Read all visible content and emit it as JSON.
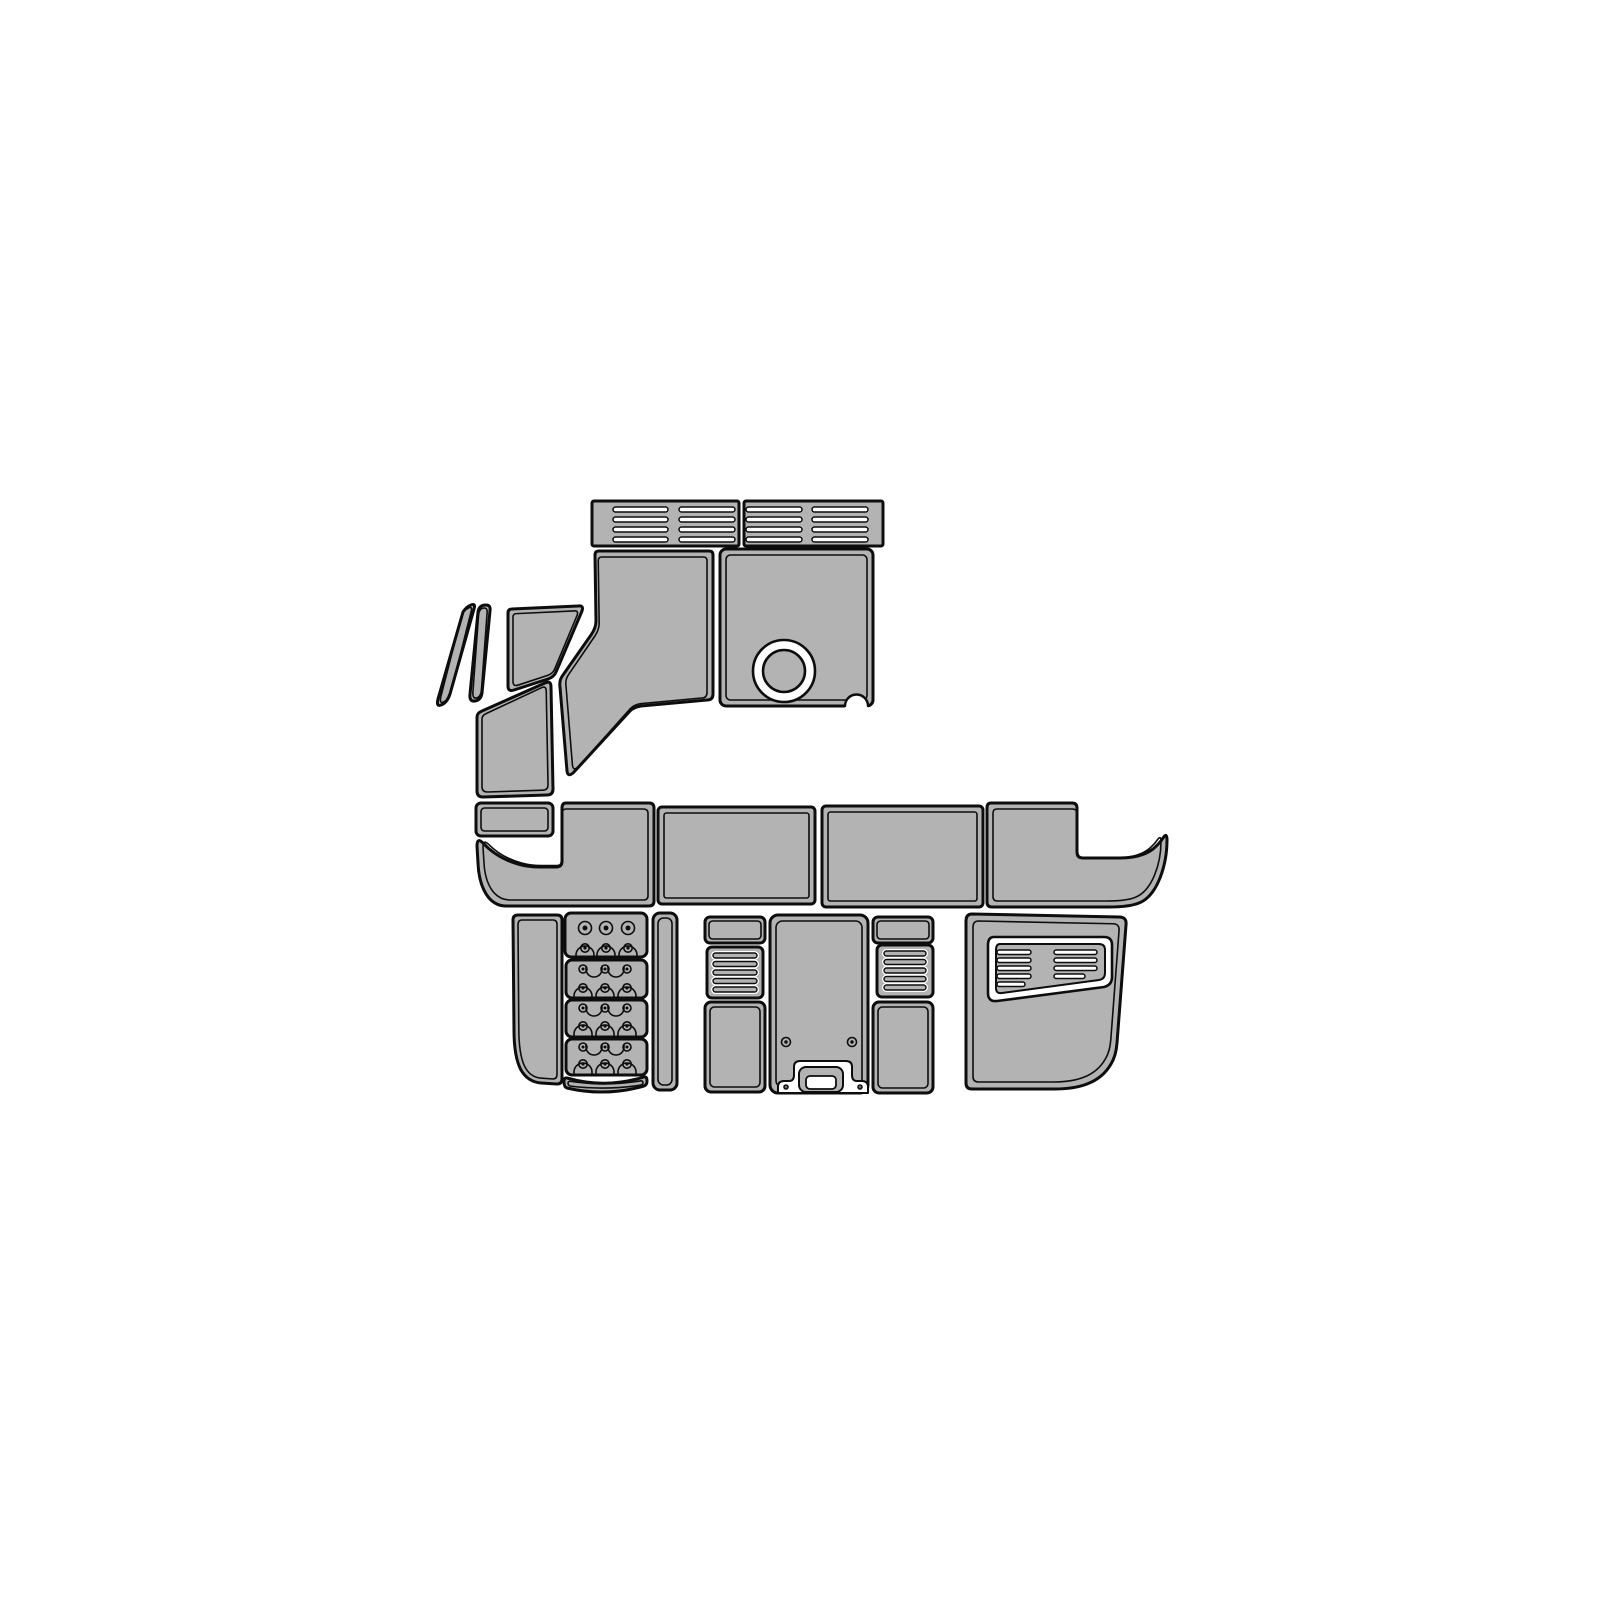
{
  "diagram": {
    "canvas": {
      "w": 1600,
      "h": 1600
    },
    "colors": {
      "background": "#ffffff",
      "pad_fill": "#b3b3b3",
      "outline": "#0d0d0d",
      "cut_fill": "#ffffff"
    },
    "pieces": [
      {
        "name": "vent-bar-left",
        "inner": false,
        "shape": {
          "kind": "rrect",
          "x": 592,
          "y": 501,
          "w": 147,
          "h": 45,
          "rx": 2
        },
        "details": [
          {
            "t": "slotw",
            "x": 613,
            "y": 507,
            "w": 55,
            "h": 5
          },
          {
            "t": "slotw",
            "x": 613,
            "y": 517,
            "w": 55,
            "h": 5
          },
          {
            "t": "slotw",
            "x": 613,
            "y": 527,
            "w": 55,
            "h": 5
          },
          {
            "t": "slotw",
            "x": 613,
            "y": 537,
            "w": 55,
            "h": 5
          },
          {
            "t": "slotw",
            "x": 679,
            "y": 507,
            "w": 56,
            "h": 5
          },
          {
            "t": "slotw",
            "x": 679,
            "y": 517,
            "w": 56,
            "h": 5
          },
          {
            "t": "slotw",
            "x": 679,
            "y": 527,
            "w": 56,
            "h": 5
          },
          {
            "t": "slotw",
            "x": 679,
            "y": 537,
            "w": 56,
            "h": 5
          }
        ]
      },
      {
        "name": "vent-bar-right",
        "inner": false,
        "shape": {
          "kind": "rrect",
          "x": 744,
          "y": 501,
          "w": 139,
          "h": 45,
          "rx": 2
        },
        "details": [
          {
            "t": "slotw",
            "x": 746,
            "y": 507,
            "w": 56,
            "h": 5
          },
          {
            "t": "slotw",
            "x": 746,
            "y": 517,
            "w": 56,
            "h": 5
          },
          {
            "t": "slotw",
            "x": 746,
            "y": 527,
            "w": 56,
            "h": 5
          },
          {
            "t": "slotw",
            "x": 746,
            "y": 537,
            "w": 56,
            "h": 5
          },
          {
            "t": "slotw",
            "x": 812,
            "y": 507,
            "w": 56,
            "h": 5
          },
          {
            "t": "slotw",
            "x": 812,
            "y": 517,
            "w": 56,
            "h": 5
          },
          {
            "t": "slotw",
            "x": 812,
            "y": 527,
            "w": 56,
            "h": 5
          },
          {
            "t": "slotw",
            "x": 812,
            "y": 537,
            "w": 56,
            "h": 5
          }
        ]
      },
      {
        "name": "helm-left-panel",
        "inset": 6,
        "shape": {
          "kind": "path",
          "d": "M 599 551 L 709 551 Q 713 551 713 555 L 713 694 Q 713 700 707 700 L 641 706 Q 634 707 630 711 L 574 772 Q 568 778 567 771 L 560 687 Q 559 680 563 675 L 591 635 Q 596 628 596 621 L 595 555 Q 595 551 599 551 Z"
        }
      },
      {
        "name": "helm-right-panel",
        "inset": 6,
        "shape": {
          "kind": "rrect",
          "x": 720,
          "y": 549,
          "w": 153,
          "h": 157,
          "rx": 6
        },
        "details": [
          {
            "t": "ring",
            "cx": 784,
            "cy": 671,
            "r1": 31,
            "r2": 21,
            "n": "cup-holder-cutout"
          },
          {
            "t": "wpath",
            "sw": 0,
            "d": "M 845 706 A 11.5 11.5 0 1 1 868 706 L 868 709 L 845 709 Z",
            "n": "corner-notch-fill"
          },
          {
            "t": "spath",
            "sw": 2.4,
            "d": "M 845 706 A 11.5 11.5 0 1 1 868 706",
            "n": "corner-notch"
          }
        ]
      },
      {
        "name": "windshield-strip-1",
        "inset": 3,
        "shape": {
          "kind": "path",
          "d": "M 471 605 Q 476 603 474 609 L 450 694 Q 447 703 441 705 Q 436 707 438 699 L 463 612 Q 466 607 471 605 Z"
        }
      },
      {
        "name": "windshield-strip-2",
        "inset": 3,
        "shape": {
          "kind": "path",
          "d": "M 486 605 Q 491 605 490 611 L 482 693 Q 481 700 475 701 Q 469 702 470 694 L 478 612 Q 479 605 486 605 Z"
        }
      },
      {
        "name": "cowl-panel",
        "inset": 5,
        "shape": {
          "kind": "path",
          "d": "M 512 609 L 578 606 Q 584 605 582 611 L 556 672 Q 554 677 548 679 L 514 690 Q 508 692 508 686 L 508 613 Q 508 609 512 609 Z"
        }
      },
      {
        "name": "side-step-panel",
        "inset": 5,
        "shape": {
          "kind": "path",
          "d": "M 482 711 L 545 683 Q 551 680 551 687 L 553 789 Q 553 795 547 795 L 483 797 Q 477 797 477 791 L 477 717 Q 477 713 482 711 Z"
        }
      },
      {
        "name": "gunnel-step-rect",
        "inset": 5,
        "shape": {
          "kind": "rrect",
          "x": 476,
          "y": 803,
          "w": 77,
          "h": 33,
          "rx": 5
        }
      },
      {
        "name": "bow-left-swoosh",
        "inset": 6,
        "shape": {
          "kind": "path",
          "d": "M 566 803 L 649 803 Q 654 803 654 808 L 654 901 Q 654 906 649 906 L 506 906 Q 496 906 489 898 Q 479 886 478 863 L 477 846 Q 477 837 483 843 Q 497 858 518 864 Q 528 867 540 867 L 556 867 Q 562 867 562 861 L 562 808 Q 562 803 566 803 Z"
        }
      },
      {
        "name": "bow-center-left-panel",
        "inset": 6,
        "shape": {
          "kind": "rrect",
          "x": 658,
          "y": 807,
          "w": 157,
          "h": 97,
          "rx": 4
        }
      },
      {
        "name": "bow-center-right-panel",
        "inset": 6,
        "shape": {
          "kind": "rrect",
          "x": 822,
          "y": 806,
          "w": 161,
          "h": 101,
          "rx": 4
        }
      },
      {
        "name": "bow-right-swoosh",
        "inset": 6,
        "shape": {
          "kind": "path",
          "d": "M 991 803 L 1072 803 Q 1077 803 1077 808 L 1077 852 Q 1077 858 1083 858 L 1120 858 Q 1141 858 1153 849 Q 1160 843 1163 838 Q 1167 832 1167 840 Q 1167 860 1160 878 Q 1152 898 1139 903 Q 1129 907 1109 907 L 992 907 Q 987 907 987 902 L 987 808 Q 987 803 991 803 Z"
        }
      },
      {
        "name": "swim-left-panel",
        "inset": 5,
        "shape": {
          "kind": "path",
          "d": "M 518 915 L 557 915 Q 562 915 562 920 L 562 1079 Q 562 1084 557 1084 L 541 1083 Q 528 1082 521 1070 Q 514 1057 514 1030 L 513 920 Q 513 915 518 915 Z"
        }
      },
      {
        "name": "step-pad-1",
        "inner": false,
        "shape": {
          "kind": "rrect",
          "x": 565,
          "y": 913,
          "w": 82,
          "h": 44,
          "rx": 6
        },
        "details": [
          {
            "t": "screw",
            "cx": 585,
            "cy": 928,
            "r": 6.5
          },
          {
            "t": "screw",
            "cx": 606,
            "cy": 928,
            "r": 6.5
          },
          {
            "t": "screw",
            "cx": 628,
            "cy": 928,
            "r": 6.5
          },
          {
            "t": "arch",
            "cx": 585,
            "y": 955,
            "r": 9
          },
          {
            "t": "arch",
            "cx": 606,
            "y": 955,
            "r": 9
          },
          {
            "t": "arch",
            "cx": 628,
            "y": 955,
            "r": 9
          },
          {
            "t": "screw",
            "cx": 585,
            "cy": 948,
            "r": 4.2
          },
          {
            "t": "screw",
            "cx": 606,
            "cy": 948,
            "r": 4.2
          },
          {
            "t": "screw",
            "cx": 628,
            "cy": 948,
            "r": 4.2
          }
        ]
      },
      {
        "name": "step-pad-2",
        "inner": false,
        "shape": {
          "kind": "rrect",
          "x": 566,
          "y": 960,
          "w": 81,
          "h": 38,
          "rx": 6
        },
        "details": [
          {
            "t": "screw",
            "cx": 583,
            "cy": 969,
            "r": 4
          },
          {
            "t": "screw",
            "cx": 605,
            "cy": 969,
            "r": 4
          },
          {
            "t": "screw",
            "cx": 627,
            "cy": 969,
            "r": 4
          },
          {
            "t": "cup",
            "cx": 594,
            "y": 969,
            "r": 8
          },
          {
            "t": "cup",
            "cx": 616,
            "y": 969,
            "r": 8
          },
          {
            "t": "arch",
            "cx": 583,
            "y": 996,
            "r": 9
          },
          {
            "t": "arch",
            "cx": 605,
            "y": 996,
            "r": 9
          },
          {
            "t": "arch",
            "cx": 627,
            "y": 996,
            "r": 9
          },
          {
            "t": "screw",
            "cx": 583,
            "cy": 988,
            "r": 4.2
          },
          {
            "t": "screw",
            "cx": 605,
            "cy": 988,
            "r": 4.2
          },
          {
            "t": "screw",
            "cx": 627,
            "cy": 988,
            "r": 4.2
          }
        ]
      },
      {
        "name": "step-pad-3",
        "inner": false,
        "shape": {
          "kind": "rrect",
          "x": 566,
          "y": 1000,
          "w": 81,
          "h": 37,
          "rx": 6
        },
        "details": [
          {
            "t": "screw",
            "cx": 583,
            "cy": 1008,
            "r": 4
          },
          {
            "t": "screw",
            "cx": 605,
            "cy": 1008,
            "r": 4
          },
          {
            "t": "screw",
            "cx": 627,
            "cy": 1008,
            "r": 4
          },
          {
            "t": "cup",
            "cx": 594,
            "y": 1008,
            "r": 8
          },
          {
            "t": "cup",
            "cx": 616,
            "y": 1008,
            "r": 8
          },
          {
            "t": "arch",
            "cx": 583,
            "y": 1034,
            "r": 9
          },
          {
            "t": "arch",
            "cx": 605,
            "y": 1034,
            "r": 9
          },
          {
            "t": "arch",
            "cx": 627,
            "y": 1034,
            "r": 9
          },
          {
            "t": "screw",
            "cx": 583,
            "cy": 1026,
            "r": 4.2
          },
          {
            "t": "screw",
            "cx": 605,
            "cy": 1026,
            "r": 4.2
          },
          {
            "t": "screw",
            "cx": 627,
            "cy": 1026,
            "r": 4.2
          }
        ]
      },
      {
        "name": "step-pad-4",
        "inner": false,
        "shape": {
          "kind": "rrect",
          "x": 566,
          "y": 1039,
          "w": 81,
          "h": 36,
          "rx": 6
        },
        "details": [
          {
            "t": "screw",
            "cx": 583,
            "cy": 1047,
            "r": 4
          },
          {
            "t": "screw",
            "cx": 605,
            "cy": 1047,
            "r": 4
          },
          {
            "t": "screw",
            "cx": 627,
            "cy": 1047,
            "r": 4
          },
          {
            "t": "cup",
            "cx": 594,
            "y": 1047,
            "r": 8
          },
          {
            "t": "cup",
            "cx": 616,
            "y": 1047,
            "r": 8
          },
          {
            "t": "arch",
            "cx": 583,
            "y": 1072,
            "r": 9
          },
          {
            "t": "arch",
            "cx": 605,
            "y": 1072,
            "r": 9
          },
          {
            "t": "arch",
            "cx": 627,
            "y": 1072,
            "r": 9
          },
          {
            "t": "screw",
            "cx": 583,
            "cy": 1064,
            "r": 4.2
          },
          {
            "t": "screw",
            "cx": 605,
            "cy": 1064,
            "r": 4.2
          },
          {
            "t": "screw",
            "cx": 627,
            "cy": 1064,
            "r": 4.2
          }
        ]
      },
      {
        "name": "step-arc-strip",
        "inset": 4,
        "shape": {
          "kind": "path",
          "d": "M 567 1078 Q 605 1089 644 1077 Q 647 1076 647 1081 Q 647 1085 644 1086 Q 605 1097 567 1088 Q 564 1087 564 1082 Q 564 1077 567 1078 Z"
        }
      },
      {
        "name": "swim-narrow-strip",
        "inset": 5,
        "shape": {
          "kind": "rrect",
          "x": 653,
          "y": 913,
          "w": 24,
          "h": 177,
          "rx": 7
        }
      },
      {
        "name": "console-top-left-rect",
        "inset": 4,
        "shape": {
          "kind": "rrect",
          "x": 705,
          "y": 917,
          "w": 60,
          "h": 26,
          "rx": 5
        }
      },
      {
        "name": "console-vent-left",
        "inner": false,
        "shape": {
          "kind": "rrect",
          "x": 707,
          "y": 947,
          "w": 56,
          "h": 51,
          "rx": 5
        },
        "details": [
          {
            "t": "slotg",
            "x": 713,
            "y": 953,
            "w": 44,
            "h": 5
          },
          {
            "t": "slotg",
            "x": 713,
            "y": 961.5,
            "w": 44,
            "h": 5
          },
          {
            "t": "slotg",
            "x": 713,
            "y": 970,
            "w": 44,
            "h": 5
          },
          {
            "t": "slotg",
            "x": 713,
            "y": 978.5,
            "w": 44,
            "h": 5
          },
          {
            "t": "slotg",
            "x": 713,
            "y": 987,
            "w": 44,
            "h": 5
          }
        ]
      },
      {
        "name": "console-side-left-rect",
        "inset": 5,
        "shape": {
          "kind": "rrect",
          "x": 705,
          "y": 1002,
          "w": 60,
          "h": 90,
          "rx": 6
        }
      },
      {
        "name": "console-center-panel",
        "inset": 6,
        "shape": {
          "kind": "rrect",
          "x": 770,
          "y": 915,
          "w": 98,
          "h": 178,
          "rx": 8
        },
        "details": [
          {
            "t": "wpath",
            "sw": 2,
            "n": "handle-cutout",
            "d": "M 778 1093 L 778 1087 Q 778 1081 784 1081 L 789 1081 Q 794 1081 794 1075 L 794 1067 Q 794 1061 800 1061 L 846 1061 Q 852 1061 852 1067 L 852 1075 Q 852 1081 857 1081 L 862 1081 Q 868 1081 868 1087 L 868 1093 Z"
          },
          {
            "t": "grrect",
            "x": 799,
            "y": 1067,
            "w": 44,
            "h": 25,
            "rx": 7,
            "n": "handle-grip-pad"
          },
          {
            "t": "wrrect",
            "x": 806,
            "y": 1076,
            "w": 30,
            "h": 13,
            "rx": 4,
            "n": "handle-grip-hole"
          },
          {
            "t": "screw",
            "cx": 786,
            "cy": 1042,
            "r": 4.5
          },
          {
            "t": "screw",
            "cx": 852,
            "cy": 1042,
            "r": 4.5
          },
          {
            "t": "screw",
            "cx": 786,
            "cy": 1087,
            "r": 2
          },
          {
            "t": "screw",
            "cx": 860,
            "cy": 1087,
            "r": 2
          }
        ]
      },
      {
        "name": "console-top-right-rect",
        "inset": 4,
        "shape": {
          "kind": "rrect",
          "x": 873,
          "y": 917,
          "w": 60,
          "h": 26,
          "rx": 5
        }
      },
      {
        "name": "console-vent-right",
        "inner": false,
        "shape": {
          "kind": "rrect",
          "x": 877,
          "y": 945,
          "w": 56,
          "h": 52,
          "rx": 5
        },
        "details": [
          {
            "t": "slotg",
            "x": 884,
            "y": 951,
            "w": 42,
            "h": 5
          },
          {
            "t": "slotg",
            "x": 884,
            "y": 959.5,
            "w": 42,
            "h": 5
          },
          {
            "t": "slotg",
            "x": 884,
            "y": 968,
            "w": 42,
            "h": 5
          },
          {
            "t": "slotg",
            "x": 884,
            "y": 976.5,
            "w": 42,
            "h": 5
          },
          {
            "t": "slotg",
            "x": 884,
            "y": 985,
            "w": 42,
            "h": 5
          }
        ]
      },
      {
        "name": "console-side-right-rect",
        "inset": 5,
        "shape": {
          "kind": "rrect",
          "x": 873,
          "y": 1002,
          "w": 60,
          "h": 91,
          "rx": 6
        }
      },
      {
        "name": "transom-right-panel",
        "inset": 7,
        "shape": {
          "kind": "path",
          "d": "M 972 914 L 1119 917 Q 1127 917 1126 925 L 1117 1043 Q 1116 1056 1111 1064 Q 1103 1078 1087 1084 Q 1074 1089 1054 1089 L 972 1089 Q 966 1089 966 1083 L 966 921 Q 966 914 972 914 Z"
        },
        "details": [
          {
            "t": "wpath",
            "sw": 2.6,
            "n": "vent-inset-ring",
            "d": "M 994 937 L 1104 937 Q 1112 937 1112 945 L 1112 977 Q 1112 985 1104 987 L 997 1001 Q 988 1002 988 993 L 988 945 Q 988 937 994 937 Z"
          },
          {
            "t": "gpath",
            "sw": 2,
            "n": "vent-inset-field",
            "d": "M 1000 944 L 1099 944 Q 1105 944 1105 950 L 1105 973 Q 1105 979 1099 980 L 1002 993 Q 996 994 996 988 L 996 950 Q 996 944 1000 944 Z"
          },
          {
            "t": "slotw",
            "x": 997,
            "y": 950,
            "w": 34,
            "h": 4.5
          },
          {
            "t": "slotw",
            "x": 997,
            "y": 958,
            "w": 34,
            "h": 4.5
          },
          {
            "t": "slotw",
            "x": 997,
            "y": 966,
            "w": 34,
            "h": 4.5
          },
          {
            "t": "slotw",
            "x": 997,
            "y": 974,
            "w": 34,
            "h": 4.5
          },
          {
            "t": "slotw",
            "x": 997,
            "y": 982,
            "w": 28,
            "h": 4.5
          },
          {
            "t": "slotw",
            "x": 1054,
            "y": 950,
            "w": 43,
            "h": 4.5
          },
          {
            "t": "slotw",
            "x": 1054,
            "y": 958,
            "w": 43,
            "h": 4.5
          },
          {
            "t": "slotw",
            "x": 1054,
            "y": 966,
            "w": 43,
            "h": 4.5
          },
          {
            "t": "slotw",
            "x": 1054,
            "y": 974,
            "w": 31,
            "h": 4.5
          }
        ]
      }
    ]
  }
}
